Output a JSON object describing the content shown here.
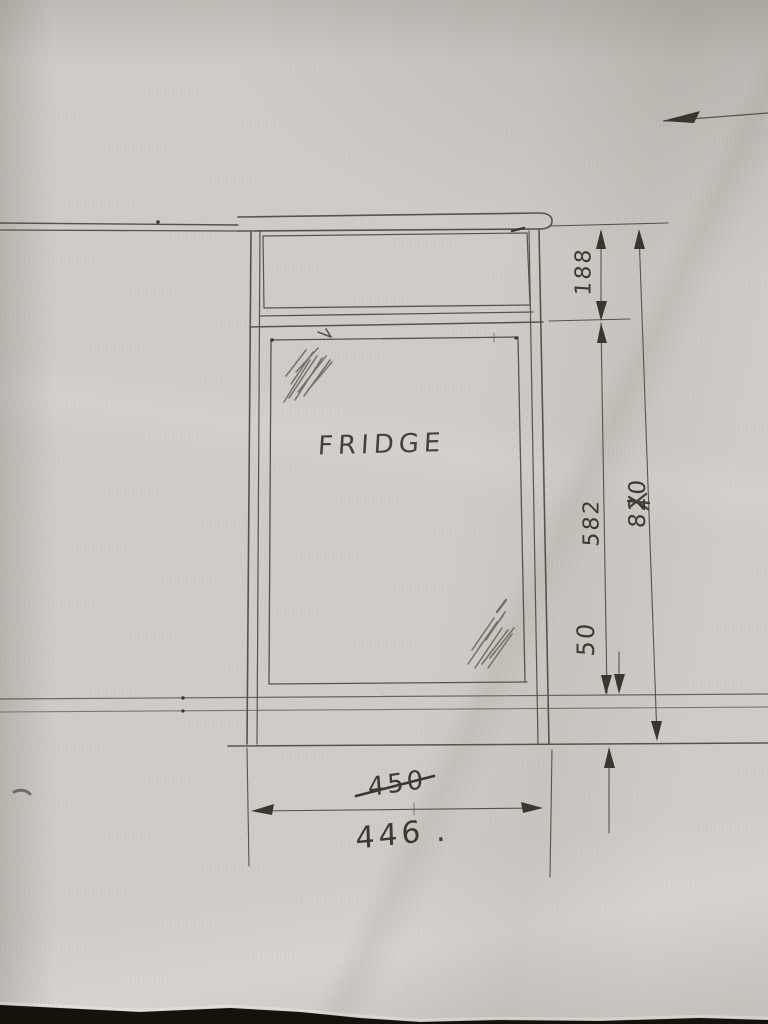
{
  "sketch": {
    "label_fridge": "FRIDGE",
    "dimensions": {
      "top_section_height": "188",
      "opening_height": "582",
      "overall_height": "820",
      "plinth_gap": "50",
      "width_crossed_out": "450",
      "width_revised": "446",
      "width_punctuation": "."
    },
    "colors": {
      "paper": "#cfccc7",
      "pencil": "#57534c",
      "pencil_dark": "#3a362f",
      "photo_background": "#17110b"
    }
  }
}
